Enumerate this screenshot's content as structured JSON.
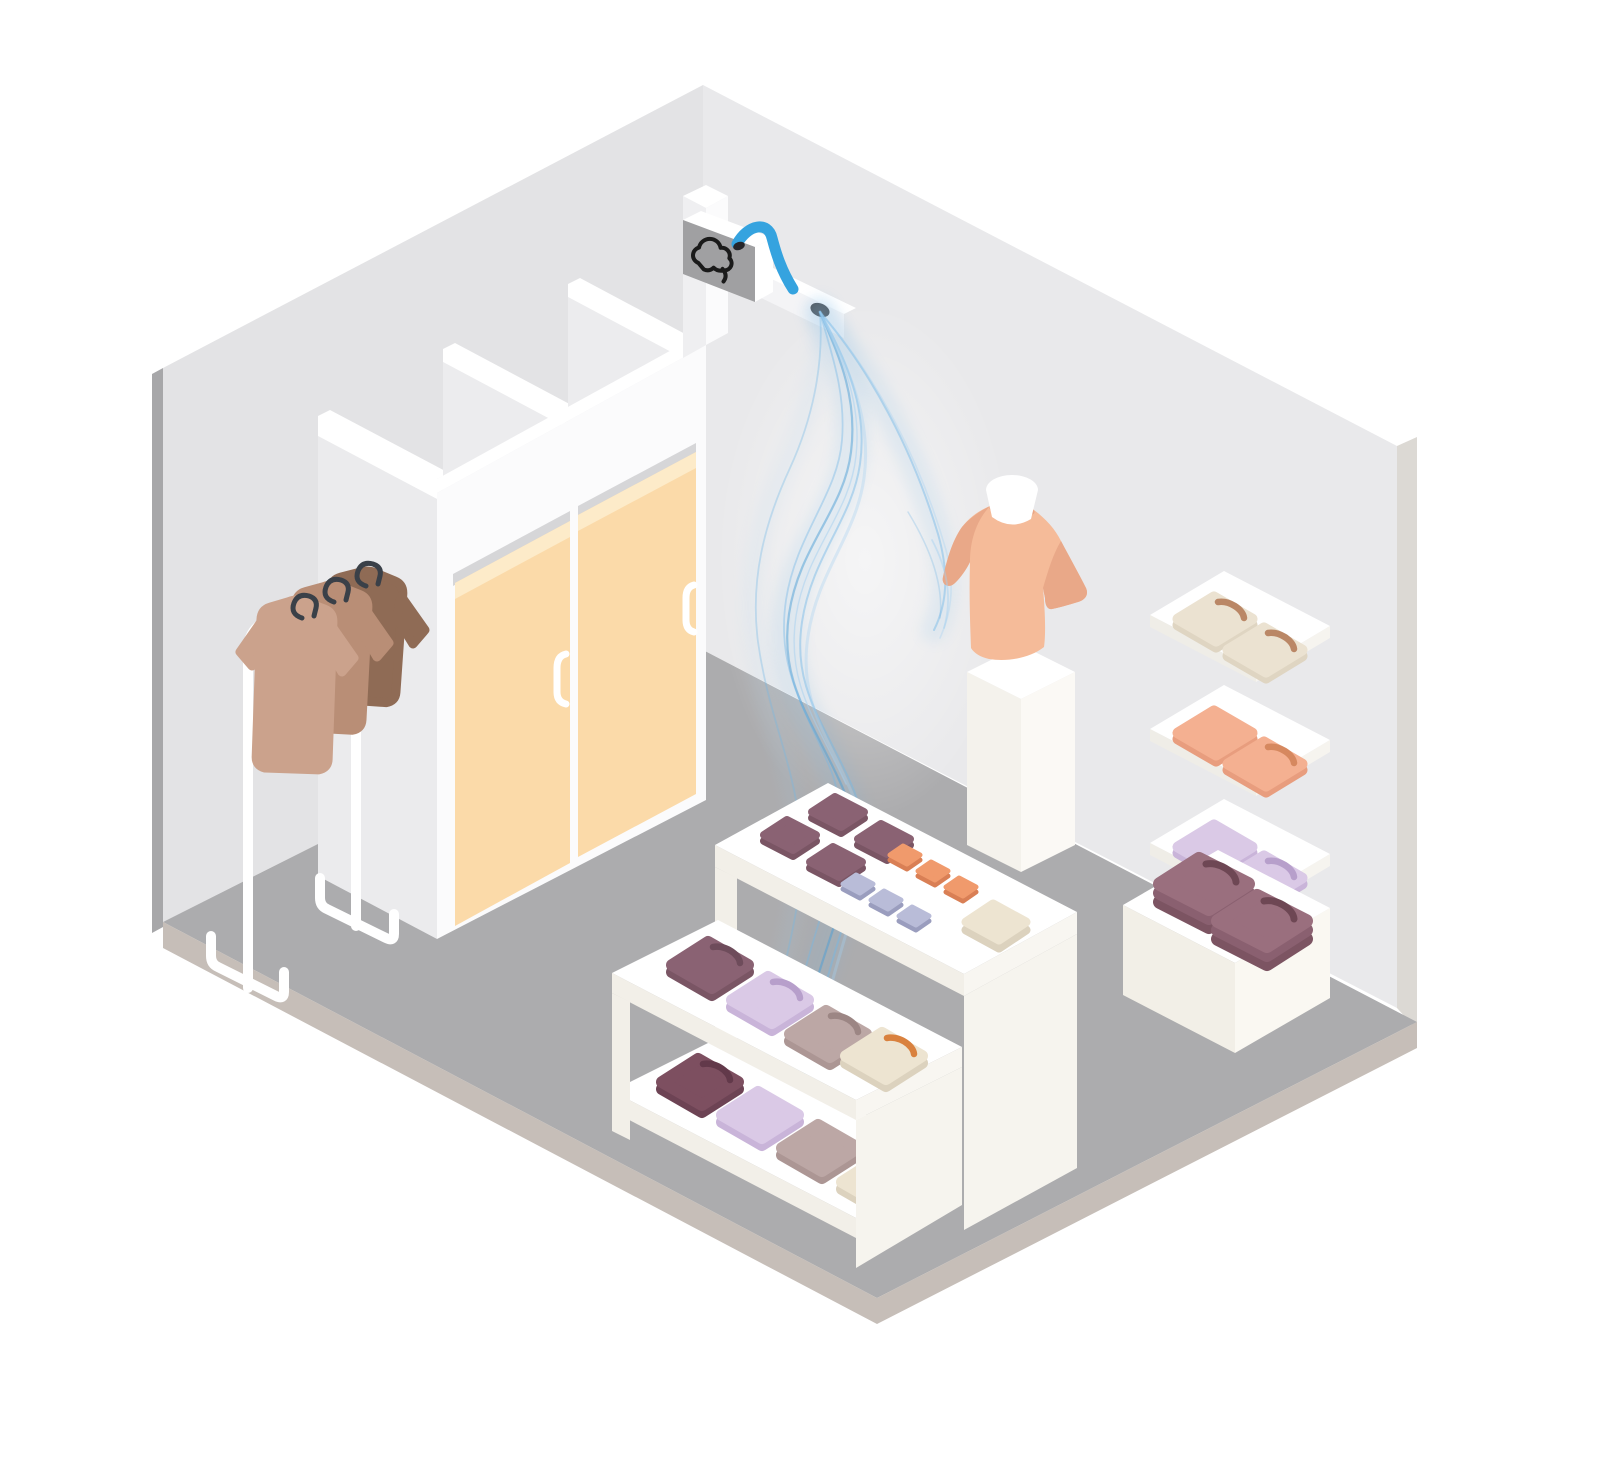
{
  "meta": {
    "description": "Isometric illustration of a clothing store interior: a scent diffuser mounted above the fitting rooms releases blue fragrance mist toward a mannequin; displays of folded shirts stand around the room.",
    "style": "flat vector isometric illustration, no text"
  },
  "palette": {
    "bg": "#FFFFFF",
    "wallLeft": "#E3E3E5",
    "wallRight": "#E9E9EB",
    "wallEdgeLeft": "#A7A7A9",
    "wallEdgeRight": "#DCD9D4",
    "floor": "#ACACAE",
    "floorRim": "#C6BEB8",
    "blockFaceFront": "#FBFBFC",
    "blockFaceSide": "#EBEBED",
    "blockTopStrip": "#FFFFFF",
    "partitionFace": "#ECECEE",
    "doorFrame": "#D6D6D8",
    "door": "#FBDAA9",
    "doorTop": "#FDEBC9",
    "handle": "#FFFFFF",
    "pillarLeft": "#EFEFF1",
    "pillarRight": "#FBFBFC",
    "ledgeTop": "#FFFFFF",
    "ledgeFace": "#F4F4F6",
    "deviceFace": "#A0A0A2",
    "deviceWhite": "#FFFFFF",
    "deviceIcon": "#1A1A1A",
    "tube": "#35A3DF",
    "nozzle": "#4E4E50",
    "mistLight": "#A5D0F0",
    "mist": "#74B7E6",
    "mistDeep": "#4E9FD6",
    "rackWhite": "#FFFFFF",
    "hanger": "#3A4048",
    "teeLight": "#CBA28C",
    "teeMid": "#B98E76",
    "teeDark": "#8F6B55",
    "shirtPeach": "#F5BB99",
    "shirtPeachShade": "#E9A888",
    "neckWhite": "#FFFFFF",
    "pedestalTop": "#FFFFFF",
    "pedestalLeft": "#F4F2EC",
    "pedestalRight": "#FBF9F5",
    "postGray": "#CFCFD1",
    "slabTop": "#FFFFFF",
    "slabLeft": "#EFEDE7",
    "slabRight": "#F6F4EF",
    "tableTop": "#FFFFFF",
    "tableBandLeft": "#F2EFE8",
    "tableBandRight": "#F8F6F1",
    "tablePanel": "#F6F4EE",
    "legFace": "#F2EFE8",
    "cubeTop": "#FFFFFF",
    "cubeLeft": "#F2EFE7",
    "cubeRight": "#FAF8F2",
    "mauveTop": "#8A6273",
    "mauveSide": "#7A5564",
    "mauveCollar": "#6E4C5B",
    "plumTop": "#7D4F60",
    "plumSide": "#6D4354",
    "plumCollar": "#62394A",
    "orangeTop": "#F09A6C",
    "orangeSide": "#D97F55",
    "periTop": "#B9BCD8",
    "periSide": "#9A9DBE",
    "creamTop": "#EDE4D1",
    "creamSide": "#DCD2BE",
    "lavTop": "#DAC9E6",
    "lavSide": "#C9B4D9",
    "lavCollar": "#B79FCB",
    "taupeTop": "#BCA7A5",
    "taupeSide": "#AC9694",
    "taupeCollar": "#9C8684",
    "wsCreamTop": "#EBE2D1",
    "wsCreamSide": "#DFD5C2",
    "wsCreamCollar": "#BA8766",
    "wsPeachTop": "#F4B091",
    "wsPeachSide": "#E89D7E",
    "wsPeachCollar": "#D6885F",
    "collarOrange": "#D9813E",
    "stackPlumTop": "#9A6F7E",
    "stackPlumMid": "#8A6070",
    "stackPlumLow": "#7C5462",
    "stackPlumCollar": "#6E4754"
  },
  "objects": {
    "room": {
      "label": "store room with two gray walls and gray floor"
    },
    "fitting_rooms": {
      "label": "fitting room block with two doors and partitions",
      "door_count": 2,
      "door_color": "#FBDAA9"
    },
    "scent_device": {
      "label": "wall-mounted scent diffuser box",
      "icon": "cloud-icon",
      "face": "#A0A0A2",
      "tube": "#35A3DF",
      "nozzle": "#4E4E50"
    },
    "mist": {
      "label": "blue fragrance mist flowing from nozzle",
      "colors": [
        "#A5D0F0",
        "#74B7E6",
        "#4E9FD6"
      ]
    },
    "clothes_rack": {
      "label": "white garment rack with three hanging shirts",
      "shirts": [
        "#CBA28C",
        "#B98E76",
        "#8F6B55"
      ],
      "hangers": 3
    },
    "mannequin": {
      "label": "mannequin torso with peach t-shirt on white pedestal",
      "shirt": "#F5BB99"
    },
    "wall_shelves": {
      "label": "three wall shelves with folded shirts",
      "rows": [
        {
          "shirt": "#EBE2D1",
          "collar": "#BA8766",
          "count": 2
        },
        {
          "shirt": "#F4B091",
          "collar": "#D6885F",
          "count": 2
        },
        {
          "shirt": "#DAC9E6",
          "collar": "#B79FCB",
          "count": 2
        }
      ]
    },
    "tall_table": {
      "label": "tall display table",
      "items": [
        {
          "name": "folded stack",
          "color": "#8A6273",
          "count": 4
        },
        {
          "name": "small bar",
          "color": "#F09A6C",
          "count": 3
        },
        {
          "name": "small bar",
          "color": "#B9BCD8",
          "count": 3
        },
        {
          "name": "flat stack",
          "color": "#EDE4D1",
          "count": 1
        }
      ]
    },
    "low_table": {
      "label": "two-shelf display table",
      "shelf1": [
        "#8A6273",
        "#DAC9E6",
        "#BCA7A5",
        "#EDE4D1"
      ],
      "shelf2": [
        "#7D4F60",
        "#DAC9E6",
        "#BCA7A5",
        "#EDE4D1"
      ]
    },
    "cube_display": {
      "label": "cream cube with two stacks of plum shirts",
      "stack_color": "#9A6F7E",
      "count": 2
    }
  }
}
